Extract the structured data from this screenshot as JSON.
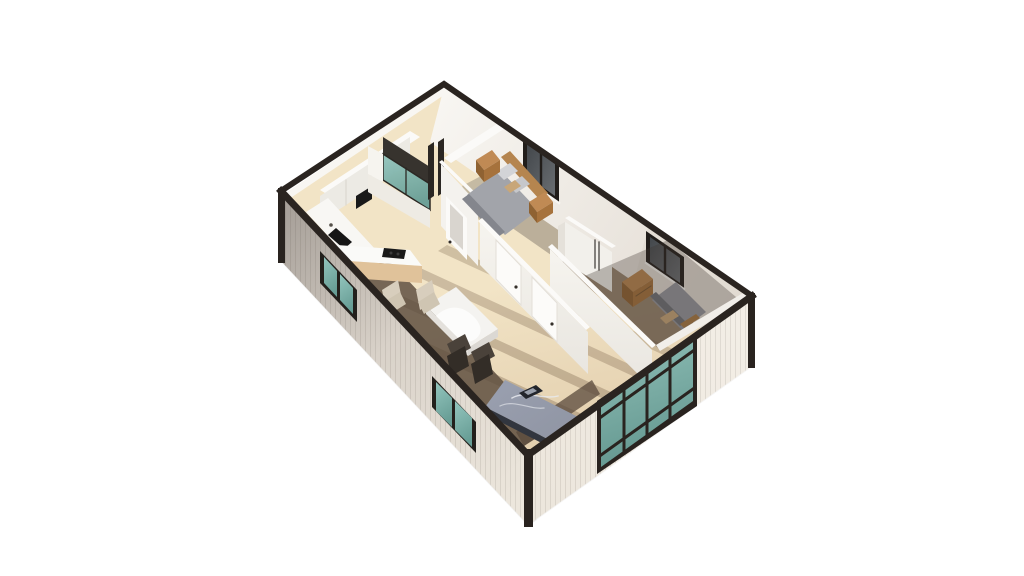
{
  "scene": {
    "type": "isometric-3d-floor-plan-render",
    "background": "#ffffff",
    "rooms": [
      "kitchen",
      "bathroom",
      "bedroom-1",
      "bedroom-2",
      "hallway-living-area",
      "dining-area"
    ],
    "furniture": [
      "kitchen-cabinets",
      "sink-counter",
      "kitchen-island-with-cooktop",
      "shower",
      "bed-1",
      "nightstands",
      "wardrobe",
      "bedroom-doors",
      "bed-2",
      "dresser",
      "dining-table",
      "beige-chairs",
      "dark-chairs",
      "gray-marble-daybed-table"
    ],
    "glazing": [
      "kitchen-window",
      "living-window",
      "bedroom-1-window",
      "bedroom-2-window",
      "glazed-entry-door"
    ],
    "palette": {
      "cap": "#2a2420",
      "frameDark": "#211d1a",
      "tealLight": "#93c5bd",
      "tealDark": "#679d95",
      "wallExtDark": "#a8a19a",
      "wallExtMid": "#d9d2c9",
      "wallExtLight": "#ece6dc",
      "wallExtRight": "#f3eee6",
      "backWallLight": "#f8f6f2",
      "backWallShade": "#e2dbd2",
      "interiorWhite": "#f6f4ef",
      "wallTopWhite": "#fbfaf8",
      "floorLight": "#f2e4c6",
      "floorMid": "#e3cfae",
      "floorShadow": "#5a4a3c",
      "woodCabinet": "#e0c29a",
      "woodCabinetDark": "#c9a77c",
      "woodFurniture": "#b5854f",
      "woodFurnitureDark": "#8f6232",
      "woodFurnitureSide": "#a6723c",
      "bedGray": "#a2a4aa",
      "bedGrayDark": "#84868d",
      "pillowLight": "#d3d4d7",
      "pillowTan": "#c8a678",
      "marbleTop": "#9aa0b0",
      "marbleBase": "#32363f",
      "chairBeige": "#d8cebd",
      "chairBeigeDark": "#cfc5b2",
      "chairDarkSeat": "#4a423a",
      "chairDarkBack": "#332d27",
      "applianceBlack": "#191919",
      "winGlassDark": "#43474b",
      "tableWhite": "#f4f3f0"
    }
  },
  "shapes": [
    {
      "n": "ground-shadow-left",
      "p": "281,262 528,526 537,520 290,256",
      "f": "#000000",
      "o": 0.05
    },
    {
      "n": "ground-shadow-right",
      "p": "528,526 752,367 759,361 535,520",
      "f": "#000000",
      "o": 0.04
    },
    {
      "n": "floor-base",
      "p": "286,193 444,87 750,297 528,452",
      "f": "url(#gFloor)"
    },
    {
      "n": "floor-light-stripe-1",
      "p": "575,421 345,315 354,309 584,415",
      "f": "#6b543c",
      "o": 0.3
    },
    {
      "n": "floor-light-stripe-2",
      "p": "606,400 376,294 385,288 615,394",
      "f": "#6b543c",
      "o": 0.3
    },
    {
      "n": "floor-light-stripe-3",
      "p": "637,378 407,272 416,266 646,372",
      "f": "#6b543c",
      "o": 0.28
    },
    {
      "n": "floor-light-stripe-4",
      "p": "668,357 438,251 447,245 677,351",
      "f": "#6b543c",
      "o": 0.26
    },
    {
      "n": "floor-shadow-left-band",
      "p": "362,274 524,446 549,430 387,258",
      "f": "$floorShadow",
      "o": 0.82
    },
    {
      "n": "floor-shadow-right-band",
      "p": "524,446 600,394 592,380 516,432",
      "f": "$floorShadow",
      "o": 0.75
    },
    {
      "n": "bedroom2-floor-shadow",
      "p": "556,258 654,346 742,300 655,240",
      "f": "#74604c",
      "o": 0.72
    },
    {
      "n": "bedroom1-floor-shadow-left",
      "p": "462,186 500,166 516,196 480,222",
      "f": "#837a6e",
      "o": 0.4
    },
    {
      "n": "bedroom1-floor-shadow-right",
      "p": "538,190 614,243 584,278 508,225",
      "f": "#837a6e",
      "o": 0.5
    },
    {
      "n": "back-left-wall-face",
      "p": "286,193 444,87 450,91 292,197",
      "f": "$backWallLight"
    },
    {
      "n": "back-right-wall-face",
      "p": "444,87 750,297 736,352 430,142",
      "f": "url(#gBackWall)"
    },
    {
      "n": "back-right-wall-shade",
      "p": "648,227 750,297 736,352 634,282",
      "f": "$backWallShade",
      "o": 0.78
    },
    {
      "n": "bedroom1-window-frame",
      "p": "523,138 559,163 559,203 523,178",
      "f": "$frameDark"
    },
    {
      "n": "bedroom1-window-glass",
      "p": "527,144 555,164 555,196 527,176",
      "f": "url(#gWinGlass)"
    },
    {
      "n": "bedroom1-window-mullion",
      "d": "M541,153 L541,187",
      "s": "$frameDark",
      "w": 2.4
    },
    {
      "n": "bedroom1-window-sill",
      "d": "M523,178 L559,203",
      "s": "#f8f6f2",
      "w": 2.4
    },
    {
      "n": "bedroom2-window-frame",
      "p": "646,231 684,257 684,289 646,263",
      "f": "$frameDark"
    },
    {
      "n": "bedroom2-window-glass",
      "p": "650,237 680,258 680,283 650,262",
      "f": "url(#gWinGlass)"
    },
    {
      "n": "bedroom2-window-mullion",
      "d": "M665,248 L665,273",
      "s": "$frameDark",
      "w": 2.4
    },
    {
      "n": "bedroom2-window-sill",
      "d": "M646,263 L684,289",
      "s": "#f8f6f2",
      "w": 2.2
    },
    {
      "n": "kitchen-cabinets-top",
      "p": "320,190 410,131 420,137 330,196",
      "f": "$wallTopWhite"
    },
    {
      "n": "kitchen-cabinets-front",
      "p": "320,196 410,137 410,163 320,222",
      "f": "#eceae4"
    },
    {
      "n": "kitchen-cabinet-seam-1",
      "d": "M346,180 L346,205",
      "s": "#d8d4cc",
      "w": 1
    },
    {
      "n": "kitchen-cabinet-seam-2",
      "d": "M371,164 L371,189",
      "s": "#d8d4cc",
      "w": 1
    },
    {
      "n": "kitchen-cabinet-seam-3",
      "d": "M394,149 L394,174",
      "s": "#d8d4cc",
      "w": 1
    },
    {
      "n": "kitchen-appliance-black",
      "p": "356,196 372,186 372,199 356,209",
      "f": "$applianceBlack"
    },
    {
      "n": "sink-counter-top",
      "p": "306,212 354,264 376,250 328,198",
      "f": "#f8f7f4"
    },
    {
      "n": "sink-counter-side",
      "p": "354,264 376,250 376,262 354,276",
      "f": "#e6e2db"
    },
    {
      "n": "sink-basin",
      "p": "336,228 352,242 344,249 328,235",
      "f": "#161616"
    },
    {
      "n": "sink-faucet",
      "c": [
        331,
        225,
        1.8
      ],
      "f": "#55504a"
    },
    {
      "n": "kitchen-island-top",
      "p": "322,244 410,250 422,266 334,260",
      "f": "#fafaf8"
    },
    {
      "n": "kitchen-island-front",
      "p": "334,260 422,266 422,283 334,277",
      "f": "$woodCabinet"
    },
    {
      "n": "kitchen-island-end",
      "p": "322,244 334,260 334,277 322,261",
      "f": "$woodCabinetDark"
    },
    {
      "n": "cooktop",
      "p": "384,248 406,250 404,259 382,257",
      "f": "$applianceBlack"
    },
    {
      "n": "cooktop-burner-1",
      "c": [
        391,
        253,
        1.5
      ],
      "f": "#3c3c3c"
    },
    {
      "n": "cooktop-burner-2",
      "c": [
        398,
        254,
        1.5
      ],
      "f": "#3c3c3c"
    },
    {
      "n": "shower-dark-back",
      "p": "383,137 430,167 430,184 383,154",
      "f": "#37332e"
    },
    {
      "n": "shower-glass",
      "p": "383,154 430,184 430,210 383,180",
      "f": "url(#gTeal)",
      "o": 0.95
    },
    {
      "n": "shower-glass-frame",
      "d": "M383,154 L430,184 L430,210 L383,180 Z",
      "s": "#2c2824",
      "w": 1.5
    },
    {
      "n": "shower-glass-mullion",
      "d": "M406,168 L406,194",
      "s": "#2c2824",
      "w": 1.3
    },
    {
      "n": "shower-right-edge",
      "p": "428,146 434,142 434,196 428,200",
      "f": "#2b2723"
    },
    {
      "n": "bathroom-right-edge",
      "p": "438,142 444,138 444,192 438,196",
      "f": "#2b2723"
    },
    {
      "n": "bathroom-left-ledge",
      "p": "368,146 383,154 383,182 368,174",
      "f": "$interiorWhite"
    },
    {
      "n": "bathroom-front-lowwall",
      "p": "368,174 430,210 430,228 368,192",
      "f": "#eeebe4"
    },
    {
      "n": "bathroom-wall-top-strip",
      "p": "439,162 480,202 483,200 442,160",
      "f": "$wallTopWhite"
    },
    {
      "n": "bathroom-right-wall-face",
      "p": "441,164 478,204 478,266 441,226",
      "f": "#f4f2ee"
    },
    {
      "n": "bathroom-door",
      "p": "446,196 467,218 467,260 446,238",
      "f": "#fbfaf8"
    },
    {
      "n": "bathroom-door-panel",
      "p": "450,204 463,217 463,250 450,237",
      "f": "#d9d5cf"
    },
    {
      "n": "bathroom-door-knob",
      "c": [
        450,
        242,
        1.5
      ],
      "f": "#2f2b28"
    },
    {
      "n": "bedroom1-divider-wall-top",
      "p": "444,158 500,122 507,127 451,163",
      "f": "$wallTopWhite"
    },
    {
      "n": "bed1-duvet",
      "p": "500,170 538,210 505,235 467,195",
      "f": "$bedGray"
    },
    {
      "n": "bed1-foot-fold",
      "p": "469,194 505,232 498,237 462,199",
      "f": "$bedGrayDark"
    },
    {
      "n": "bed1-headboard",
      "p": "501,157 510,151 548,193 539,199",
      "f": "$woodFurniture"
    },
    {
      "n": "bed1-pillow-1",
      "p": "496,172 510,163 518,171 504,180",
      "f": "$pillowLight"
    },
    {
      "n": "bed1-pillow-2",
      "p": "508,185 522,176 530,184 516,193",
      "f": "#c6c7cb"
    },
    {
      "n": "bed1-pillow-tan",
      "p": "504,187 515,180 521,186 510,193",
      "f": "$pillowTan"
    },
    {
      "n": "nightstand1-top",
      "p": "476,160 492,150 500,160 484,170",
      "f": "#c08a54"
    },
    {
      "n": "nightstand1-front",
      "p": "476,160 484,170 484,182 476,172",
      "f": "$woodFurnitureDark"
    },
    {
      "n": "nightstand1-side",
      "p": "484,170 500,160 500,172 484,182",
      "f": "$woodFurnitureSide"
    },
    {
      "n": "nightstand2-top",
      "p": "529,202 545,192 553,202 537,212",
      "f": "#c08a54"
    },
    {
      "n": "nightstand2-front",
      "p": "529,202 537,212 537,223 529,213",
      "f": "$woodFurnitureDark"
    },
    {
      "n": "nightstand2-side",
      "p": "537,212 553,202 553,213 537,223",
      "f": "$woodFurnitureSide"
    },
    {
      "n": "wardrobe-side",
      "p": "558,226 565,222 565,260 558,264",
      "f": "#e5e1da"
    },
    {
      "n": "wardrobe-top",
      "p": "565,218 612,248 616,246 569,216",
      "f": "$wallTopWhite"
    },
    {
      "n": "wardrobe-front",
      "p": "565,222 612,252 612,292 565,262",
      "f": "#f2f0eb"
    },
    {
      "n": "wardrobe-handles",
      "d": "M595,240 L595,268 M599,242 L599,270",
      "s": "#3a3632",
      "w": 1.2
    },
    {
      "n": "dresser-top",
      "p": "622,282 642,269 653,279 633,292",
      "f": "#b9854e"
    },
    {
      "n": "dresser-front",
      "p": "622,282 633,292 633,307 622,297",
      "f": "$woodFurnitureDark"
    },
    {
      "n": "dresser-side",
      "p": "633,292 653,279 653,294 633,307",
      "f": "$woodFurnitureSide"
    },
    {
      "n": "dresser-drawer-line",
      "d": "M636,296 L651,286",
      "s": "#7a5730",
      "w": 1
    },
    {
      "n": "bed2-duvet",
      "p": "652,300 682,330 706,312 676,282",
      "f": "#94969d"
    },
    {
      "n": "bed2-headboard",
      "p": "650,296 680,326 686,322 656,292",
      "f": "#6e7076"
    },
    {
      "n": "bed2-pillow-tan",
      "p": "660,318 673,310 679,316 666,324",
      "f": "$pillowTan"
    },
    {
      "n": "bed2-wood-bench",
      "p": "680,324 696,314 700,318 684,328",
      "f": "#a87943"
    },
    {
      "n": "bedroom2-shadow-overlay",
      "p": "580,278 660,350 742,302 668,240",
      "f": "#3e3630",
      "o": 0.32
    },
    {
      "n": "bedroom2-wall-top",
      "p": "548,247 652,348 656,345 552,244",
      "f": "$wallTopWhite"
    },
    {
      "n": "bedroom2-wall-face",
      "p": "550,249 652,350 652,388 550,287",
      "f": "url(#gPartWall)"
    },
    {
      "n": "frontwall-interior-strip",
      "p": "656,345 748,290 752,296 660,351",
      "f": "#f1eee9"
    },
    {
      "n": "doors-wall-top",
      "p": "478,221 586,330 590,327 482,218",
      "f": "$wallTopWhite"
    },
    {
      "n": "doors-wall-face",
      "p": "480,223 588,332 588,374 480,265",
      "f": "url(#gPartWall)"
    },
    {
      "n": "bedroom1-door",
      "p": "496,240 521,266 521,305 496,279",
      "f": "#fcfbf9"
    },
    {
      "n": "bedroom1-door-outline",
      "d": "M496,240 L521,266 L521,305 L496,279 Z",
      "s": "#e3dfd8",
      "w": 1
    },
    {
      "n": "bedroom1-door-knob",
      "c": [
        516,
        287,
        1.6
      ],
      "f": "#35302b"
    },
    {
      "n": "closet-door",
      "p": "532,277 557,303 557,342 532,316",
      "f": "#fcfbf9"
    },
    {
      "n": "closet-door-outline",
      "d": "M532,277 L557,303 L557,342 L532,316 Z",
      "s": "#e3dfd8",
      "w": 1
    },
    {
      "n": "closet-door-knob",
      "c": [
        552,
        324,
        1.6
      ],
      "f": "#35302b"
    },
    {
      "n": "dining-table-top",
      "p": "426,306 456,287 498,329 468,348",
      "f": "$tableWhite"
    },
    {
      "n": "dining-tablecloth-drape",
      "d": "M436,316 C446,306 460,304 472,315 C482,324 484,334 474,340 C462,346 446,338 436,316 Z",
      "f": "#fdfdfc",
      "o": 0.9
    },
    {
      "n": "dining-table-side-left",
      "p": "426,306 468,348 468,356 426,314",
      "f": "#e4e1dc"
    },
    {
      "n": "dining-table-side-right",
      "p": "468,348 498,329 498,337 468,356",
      "f": "#dbd8d3"
    },
    {
      "n": "beige-chair1-back",
      "p": "382,290 398,280 402,300 386,310",
      "f": "$chairBeige"
    },
    {
      "n": "beige-chair1-seat",
      "p": "384,302 400,292 406,304 390,314",
      "f": "$chairBeigeDark"
    },
    {
      "n": "beige-chair2-back",
      "p": "416,290 432,280 436,300 420,310",
      "f": "$chairBeige"
    },
    {
      "n": "beige-chair2-seat",
      "p": "418,302 434,292 440,304 424,314",
      "f": "$chairBeigeDark"
    },
    {
      "n": "dark-chair1-seat",
      "p": "447,344 465,334 471,348 453,358",
      "f": "$chairDarkSeat"
    },
    {
      "n": "dark-chair1-back",
      "p": "447,356 465,346 469,366 451,376",
      "f": "$chairDarkBack"
    },
    {
      "n": "dark-chair2-seat",
      "p": "471,352 489,342 495,356 477,366",
      "f": "$chairDarkSeat"
    },
    {
      "n": "dark-chair2-back",
      "p": "471,364 489,354 493,374 475,384",
      "f": "$chairDarkBack"
    },
    {
      "n": "daybed-top",
      "p": "505,380 588,422 565,448 485,407",
      "f": "url(#gMarble)"
    },
    {
      "n": "daybed-vein-1",
      "d": "M512,398 C526,390 544,400 558,396",
      "s": "#e8eaee",
      "w": 1.4,
      "o": 0.85
    },
    {
      "n": "daybed-vein-2",
      "d": "M500,406 C514,399 530,410 544,408",
      "s": "#dfe2e8",
      "w": 1.2,
      "o": 0.7
    },
    {
      "n": "daybed-base-left",
      "p": "485,407 565,448 565,455 485,414",
      "f": "$marbleBase"
    },
    {
      "n": "daybed-base-right",
      "p": "565,448 588,422 588,429 565,455",
      "f": "#282c34"
    },
    {
      "n": "daybed-object",
      "p": "519,393 536,385 543,391 526,399",
      "f": "#22252c"
    },
    {
      "n": "daybed-object-screen",
      "p": "524,392 533,388 537,391 528,395",
      "f": "#9aa0ac"
    },
    {
      "n": "exterior-wall-left",
      "p": "281,191 528,455 528,525 281,261",
      "f": "url(#gLeftWall)"
    },
    {
      "n": "exterior-wall-left-siding",
      "p": "281,191 528,455 528,525 281,261",
      "f": "url(#pSiding)"
    },
    {
      "n": "kitchen-window-frame",
      "p": "320,251 357,290 357,322 320,283",
      "f": "#23201c"
    },
    {
      "n": "kitchen-window-glass-1",
      "p": "324,257 337,271 337,297 324,283",
      "f": "url(#gTeal)"
    },
    {
      "n": "kitchen-window-glass-2",
      "p": "340,274 353,288 353,314 340,300",
      "f": "url(#gTeal)"
    },
    {
      "n": "living-window-frame",
      "p": "432,376 476,422 476,453 432,407",
      "f": "#23201c"
    },
    {
      "n": "living-window-glass-1",
      "p": "436,382 452,398 452,427 436,411",
      "f": "url(#gTeal)"
    },
    {
      "n": "living-window-glass-2",
      "p": "455,401 472,418 472,447 455,430",
      "f": "url(#gTeal)"
    },
    {
      "n": "exterior-wall-right",
      "p": "528,455 752,296 752,366 528,525",
      "f": "url(#gRightWall)"
    },
    {
      "n": "exterior-wall-right-siding",
      "p": "528,455 752,296 752,366 528,525",
      "f": "url(#pSiding)"
    },
    {
      "n": "glazed-door-frame",
      "p": "597,401 697,333 697,406 597,474",
      "f": "#29231f"
    },
    {
      "n": "glazed-door-glass",
      "p": "601,405 693,339 693,401 601,467",
      "f": "url(#gTeal)",
      "o": 0.96
    },
    {
      "n": "glazed-door-mullion-v1",
      "d": "M624,388 L624,451",
      "s": "#29231f",
      "w": 3
    },
    {
      "n": "glazed-door-mullion-v2",
      "d": "M647,372 L647,434",
      "s": "#29231f",
      "w": 3
    },
    {
      "n": "glazed-door-mullion-v3",
      "d": "M670,355 L670,418",
      "s": "#29231f",
      "w": 3
    },
    {
      "n": "glazed-door-rail-top",
      "d": "M601,417 L693,351",
      "s": "#29231f",
      "w": 3
    },
    {
      "n": "glazed-door-rail-bottom",
      "d": "M601,455 L693,389",
      "s": "#29231f",
      "w": 3
    },
    {
      "n": "corner-post-south",
      "p": "524,449 533,449 533,527 524,527",
      "f": "#29231f"
    },
    {
      "n": "corner-post-west",
      "p": "278,188 285,188 285,263 278,263",
      "f": "#29231f"
    },
    {
      "n": "corner-post-east",
      "p": "748,293 755,293 755,368 748,368",
      "f": "#29231f"
    },
    {
      "n": "wall-cap-back",
      "d": "M281,191 L444,84 L752,296",
      "s": "$cap",
      "w": 6
    },
    {
      "n": "wall-cap-front",
      "d": "M281,191 L528,455 L752,296",
      "s": "$cap",
      "w": 7
    }
  ]
}
